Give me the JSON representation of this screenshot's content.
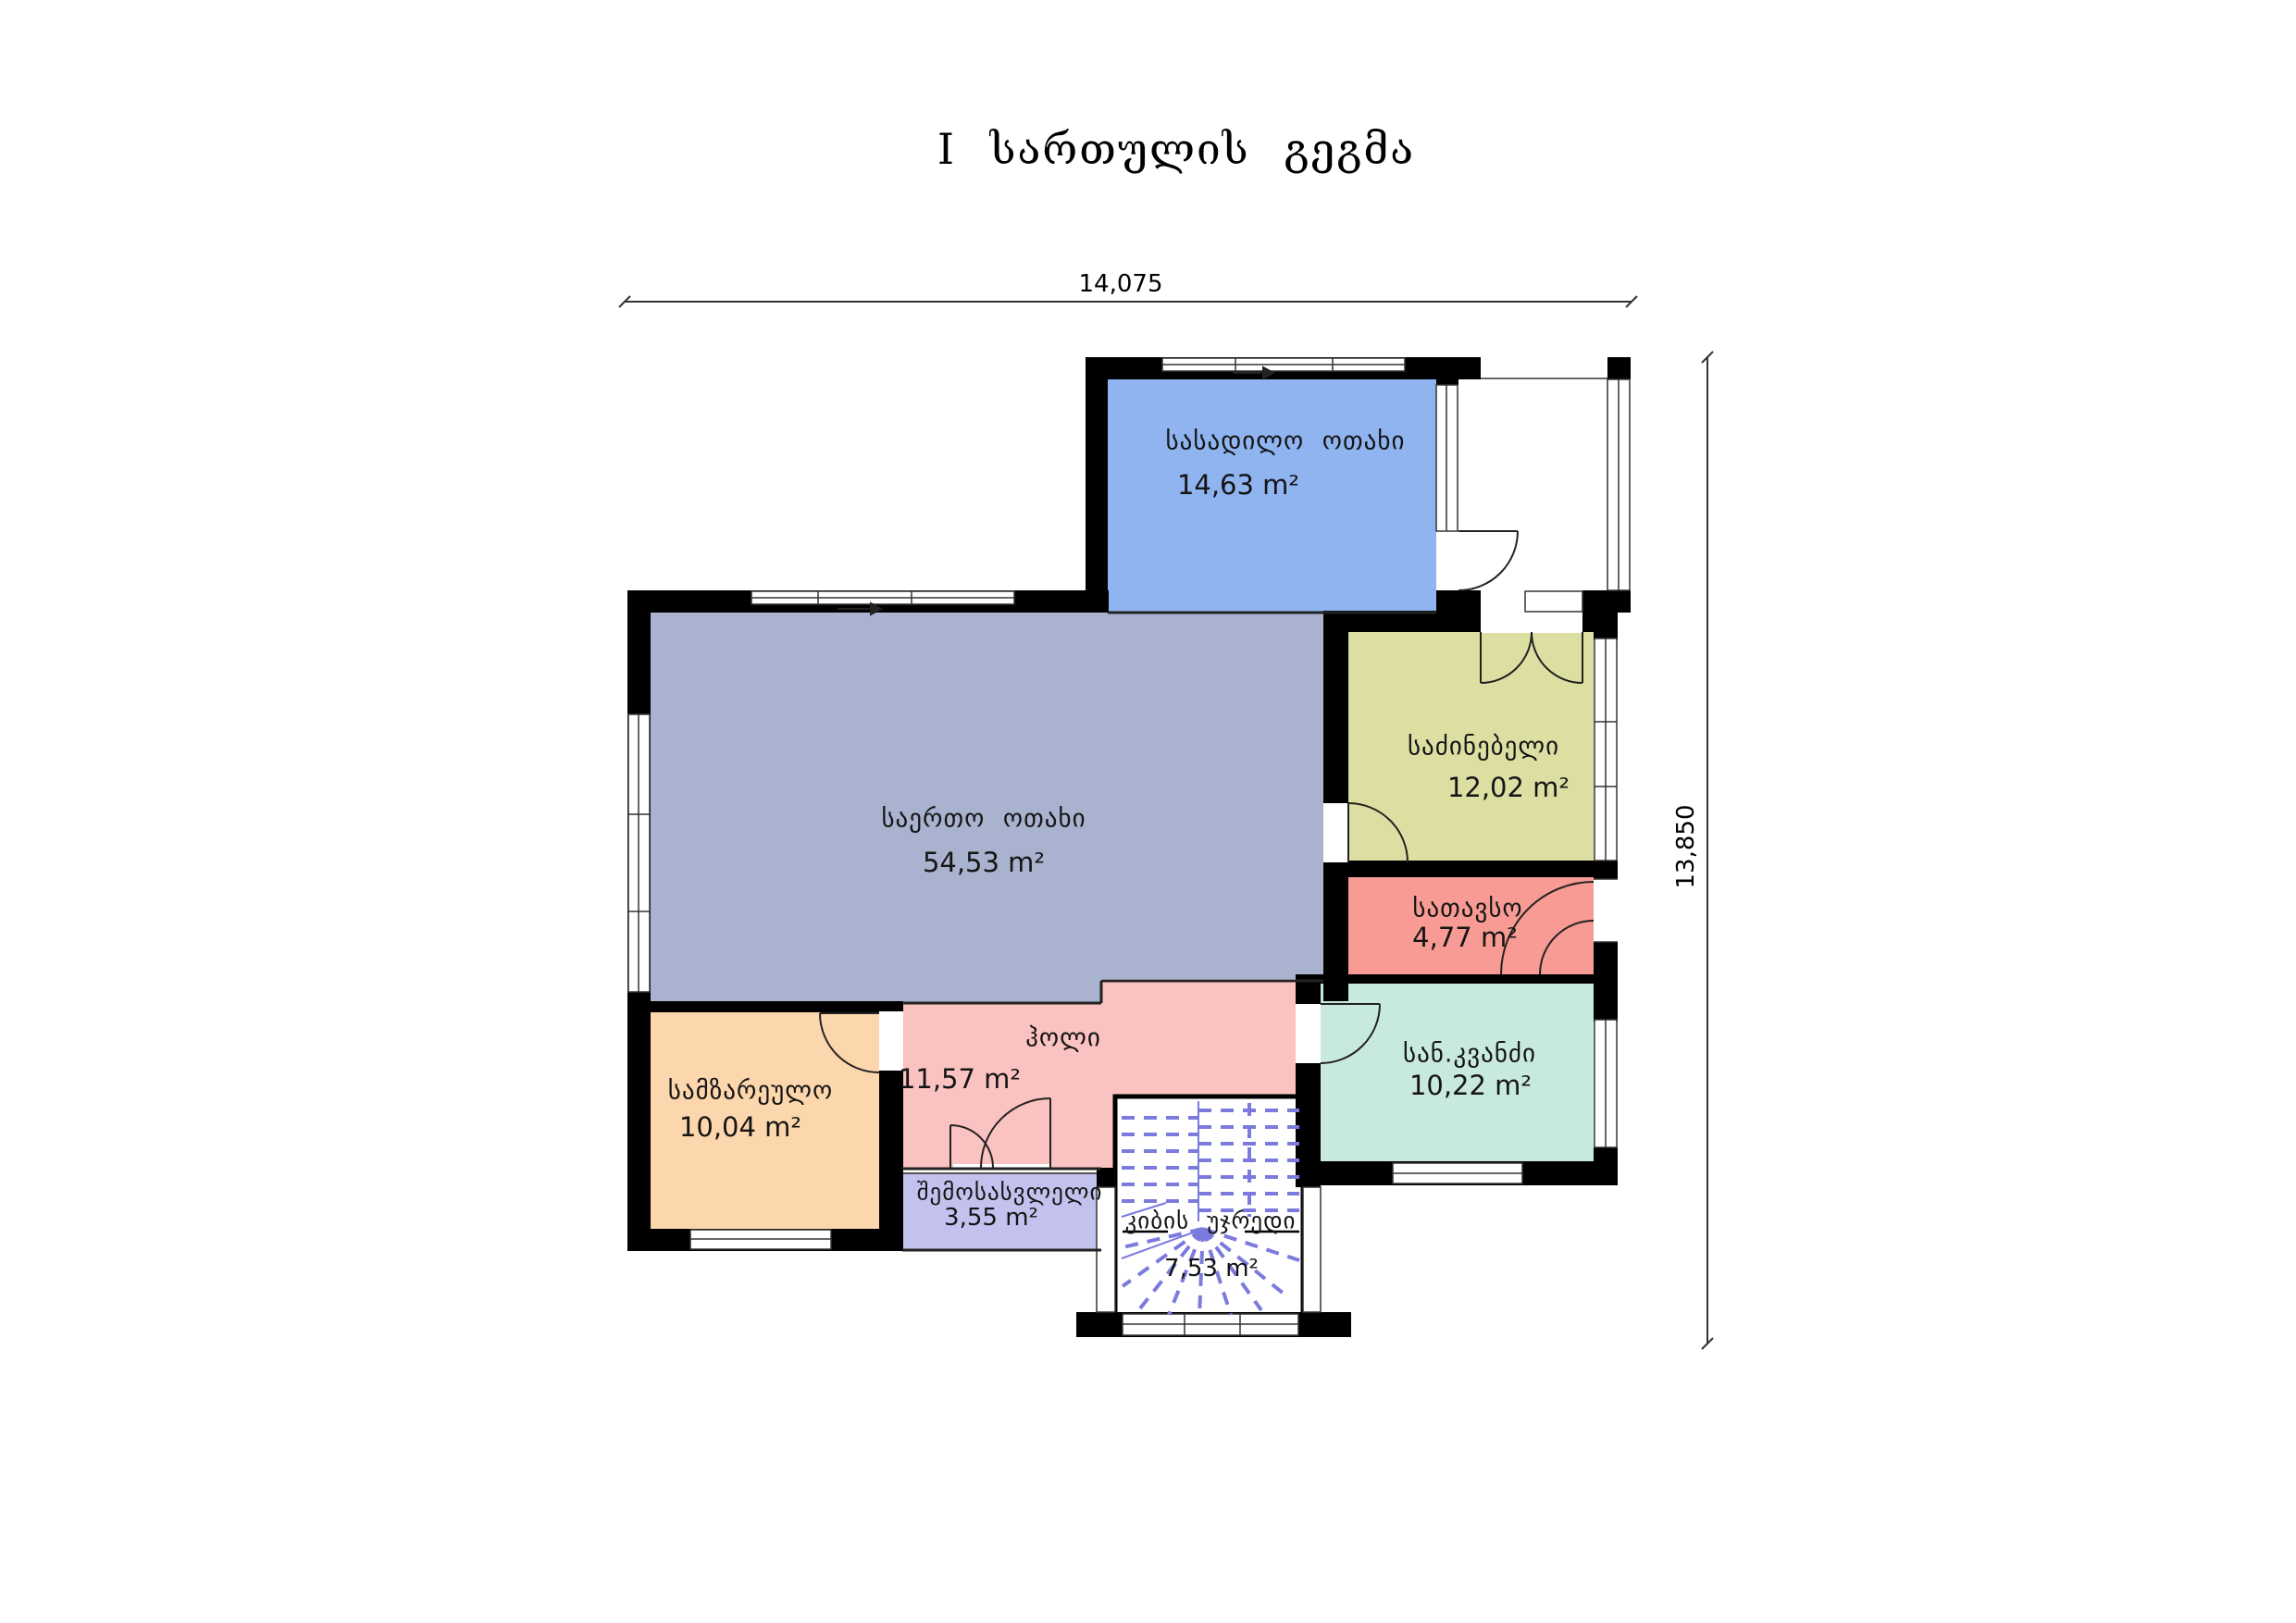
{
  "title": "I სართულის გეგმა",
  "dimensions": {
    "width_label": "14,075",
    "height_label": "13,850"
  },
  "rooms": [
    {
      "id": "dining",
      "name": "სასადილო ოთახი",
      "area": "14,63 m²",
      "color": "#8FB4EF"
    },
    {
      "id": "living",
      "name": "საერთო ოთახი",
      "area": "54,53 m²",
      "color": "#A9B2CE"
    },
    {
      "id": "bedroom",
      "name": "საძინებელი",
      "area": "12,02 m²",
      "color": "#DDDFA2"
    },
    {
      "id": "storage",
      "name": "სათავსო",
      "area": "4,77 m²",
      "color": "#F89B94"
    },
    {
      "id": "hall",
      "name": "ჰოლი",
      "area": "11,57 m²",
      "color": "#FAC2C1"
    },
    {
      "id": "kitchen",
      "name": "სამზარეულო",
      "area": "10,04 m²",
      "color": "#FCD6AC"
    },
    {
      "id": "entrance",
      "name": "შემოსასვლელი",
      "area": "3,55 m²",
      "color": "#C3C2EE"
    },
    {
      "id": "stairs",
      "name": "კიბის უჯრედი",
      "area": "7,53 m²",
      "color": "#FFFFFF"
    },
    {
      "id": "sanitary",
      "name": "სან.კვანძი",
      "area": "10,22 m²",
      "color": "#C8E9E0"
    }
  ],
  "colors": {
    "wall": "#000000",
    "stair_lines": "#7B7BDE",
    "dimension_line": "#333333"
  }
}
